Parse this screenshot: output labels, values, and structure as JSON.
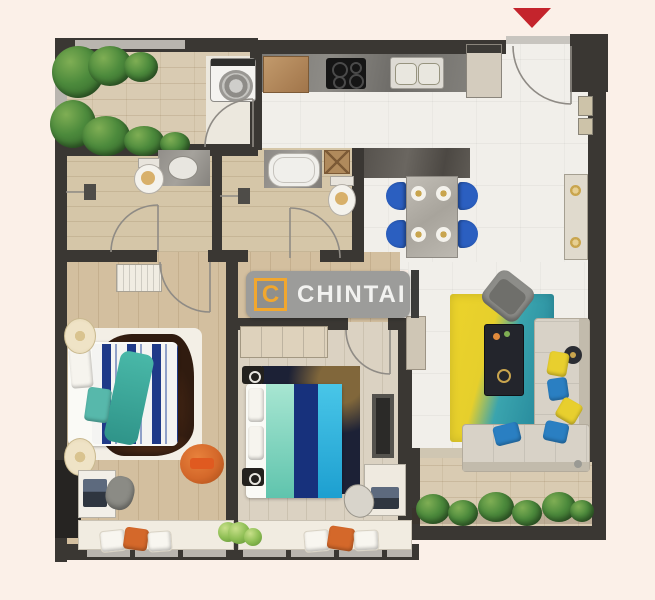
{
  "brand": {
    "monogram": "C",
    "name": "CHINTAI"
  },
  "entrance_marker": {
    "shape": "triangle-down",
    "color": "#c4242c"
  },
  "palette": {
    "background": "#fbf0e8",
    "wall": "#3a3733",
    "window_frame": "#b9b5af",
    "floor_white": "#f1efea",
    "floor_balcony_tile": "#d9cbb2",
    "floor_bathroom": "#d5c6a8",
    "floor_bedroom_wood": "#d3bf9f",
    "floor_bedroom2_wood": "#dbd2c2",
    "logo_band": "#9c9c9a",
    "logo_accent_orange": "#f2a72e",
    "logo_text": "#f2f2f0",
    "dining_chair_blue": "#2b5fc0",
    "rug_yellow": "#e9d22b",
    "rug_teal": "#2796a6",
    "sofa_beige": "#d8d2c7",
    "bed_navy": "#1f3a88",
    "bed_mint": "#8fd9c4",
    "bed_cyan": "#2fb0de",
    "throw_teal": "#3aa99b",
    "accent_orange_pouf": "#d4682a",
    "plant_green": "#4c8a3c"
  }
}
